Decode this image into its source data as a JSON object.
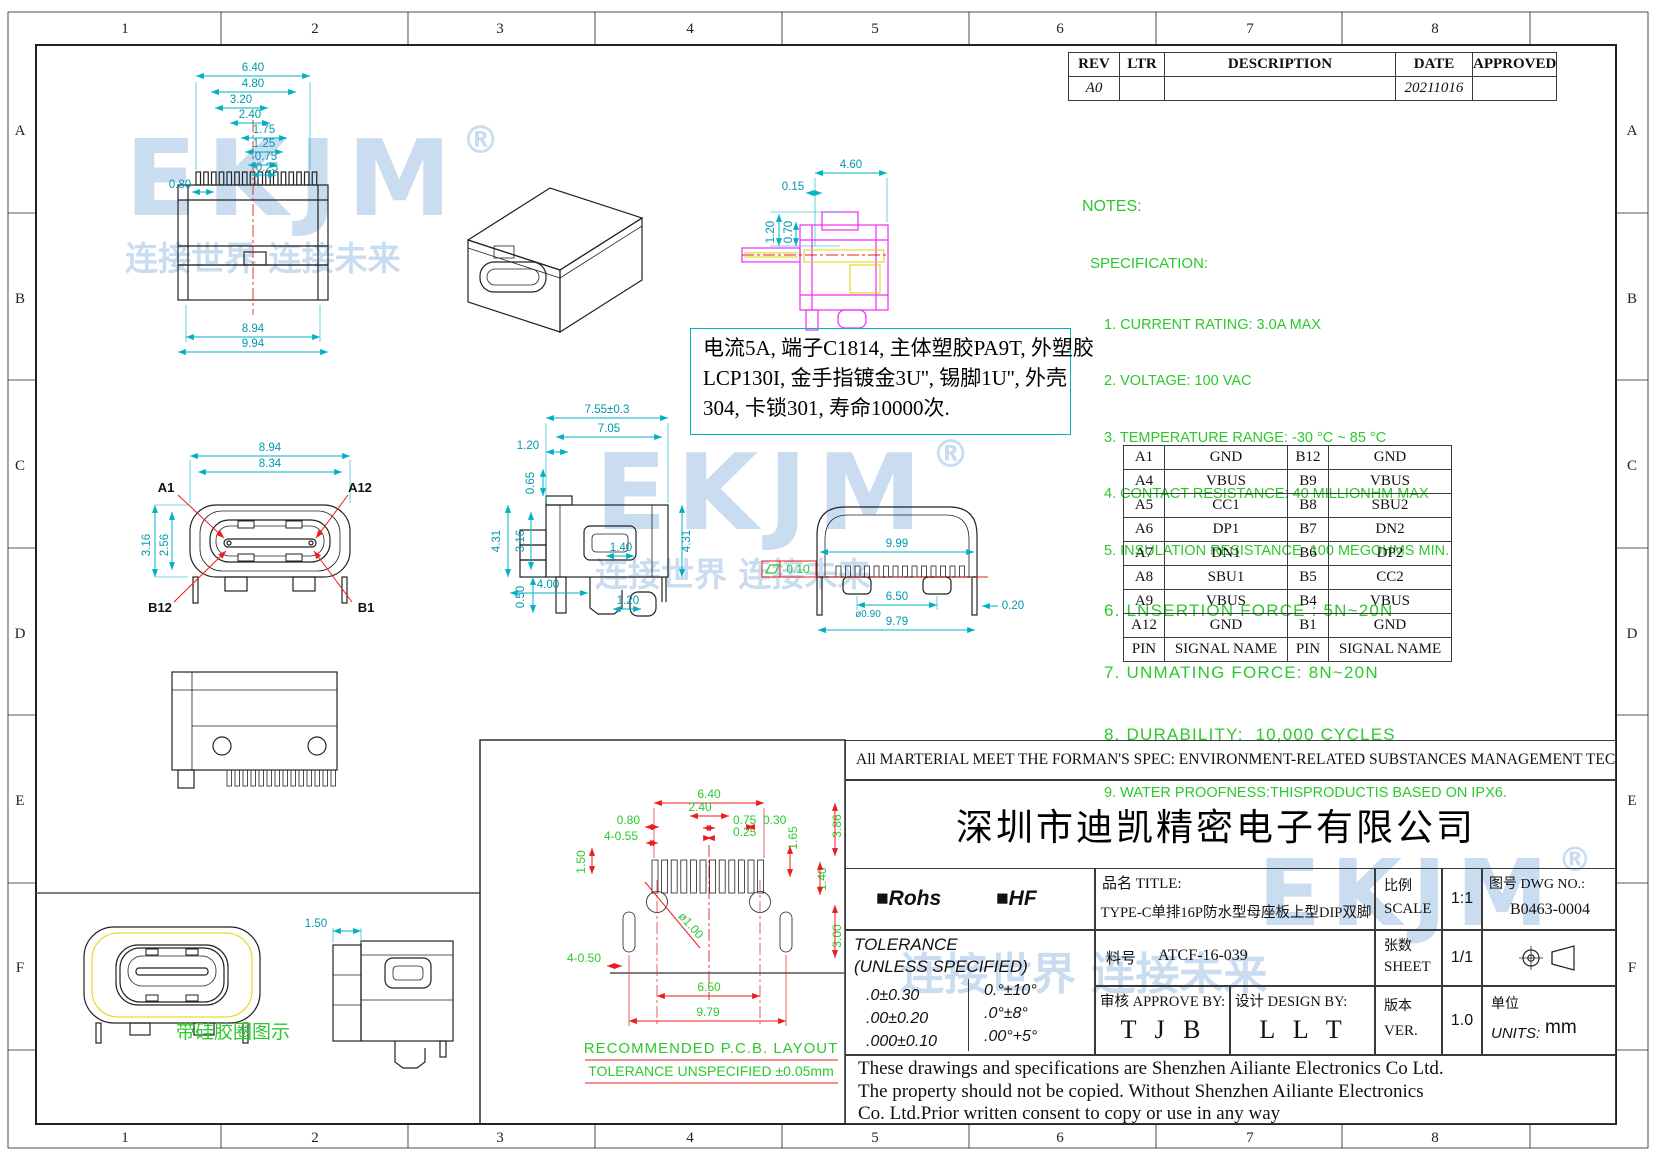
{
  "colors": {
    "cyan": "#00b0c4",
    "green": "#2dc82d",
    "red": "#ec1c1c",
    "magenta": "#f02cf0",
    "yellow": "#e0d200",
    "watermark_blue": "#c9dcf0",
    "line": "#222222"
  },
  "border": {
    "cols": [
      "1",
      "2",
      "3",
      "4",
      "5",
      "6",
      "7",
      "8"
    ],
    "rows": [
      "A",
      "B",
      "C",
      "D",
      "E",
      "F"
    ]
  },
  "rev_table": {
    "headers": [
      "REV",
      "LTR",
      "DESCRIPTION",
      "DATE",
      "APPROVED"
    ],
    "row": {
      "rev": "A0",
      "ltr": "",
      "description": "",
      "date": "20211016",
      "approved": ""
    }
  },
  "watermark": {
    "logo": "EKJM",
    "reg": "®",
    "slogan": "连接世界  连接未来"
  },
  "notes": {
    "title": "NOTES:",
    "subtitle": "SPECIFICATION:",
    "items": [
      "1. CURRENT RATING: 3.0A MAX",
      "2. VOLTAGE: 100 VAC",
      "3. TEMPERATURE RANGE: -30 °C ~ 85 °C",
      "4. CONTACT RESISTANCE: 40 MILLIONHM MAX",
      "5. INSULATION RESISTANCE: 100 MEGOHMS MIN.",
      "6. LNSERTION FORCE : 5N~20N",
      "7. UNMATING FORCE: 8N~20N",
      "8. DURABILITY:  10,000 CYCLES",
      "9. WATER PROOFNESS:THISPRODUCTIS BASED ON IPX6."
    ]
  },
  "material_note": {
    "lines": [
      "电流5A, 端子C1814, 主体塑胶PA9T, 外塑胶",
      "LCP130I, 金手指镀金3U'', 锡脚1U'', 外壳",
      "304, 卡锁301, 寿命10000次."
    ]
  },
  "pin_table": {
    "rows": [
      [
        "A1",
        "GND",
        "B12",
        "GND"
      ],
      [
        "A4",
        "VBUS",
        "B9",
        "VBUS"
      ],
      [
        "A5",
        "CC1",
        "B8",
        "SBU2"
      ],
      [
        "A6",
        "DP1",
        "B7",
        "DN2"
      ],
      [
        "A7",
        "DN1",
        "B6",
        "DP2"
      ],
      [
        "A8",
        "SBU1",
        "B5",
        "CC2"
      ],
      [
        "A9",
        "VBUS",
        "B4",
        "VBUS"
      ],
      [
        "A12",
        "GND",
        "B1",
        "GND"
      ],
      [
        "PIN",
        "SIGNAL NAME",
        "PIN",
        "SIGNAL NAME"
      ]
    ]
  },
  "views": {
    "plan": {
      "dims": [
        "6.40",
        "4.80",
        "3.20",
        "2.40",
        "1.75",
        "1.25",
        "0.75",
        "0.25",
        "0.80",
        "8.94",
        "9.94"
      ]
    },
    "section": {
      "dims": [
        "4.60",
        "0.15",
        "1.20",
        "0.70"
      ]
    },
    "front": {
      "dims": [
        "8.94",
        "8.34",
        "3.16",
        "2.56"
      ],
      "pins": [
        "A1",
        "A12",
        "B12",
        "B1"
      ]
    },
    "side": {
      "dims": [
        "7.55±0.3",
        "7.05",
        "1.20",
        "0.65",
        "4.31",
        "3.16",
        "4.31",
        "1.40",
        "0.50",
        "1.20",
        "4.00"
      ]
    },
    "rear": {
      "dims": [
        "9.99",
        "6.50",
        "ø0.90",
        "9.79",
        "0.20"
      ],
      "flatness": "0.10"
    },
    "gasket": {
      "dim": "1.50",
      "label": "带硅胶圈图示"
    }
  },
  "pcb": {
    "dims": [
      "6.40",
      "2.40",
      "0.75",
      "0.25",
      "0.80",
      "4-0.55",
      "0.30",
      "1.65",
      "1.50",
      "1.40",
      "ø1.00",
      "4-0.50",
      "6.50",
      "9.79",
      "3.00",
      "3.86"
    ],
    "label1": "RECOMMENDED   P.C.B. LAYOUT",
    "label2": "TOLERANCE UNSPECIFIED ±0.05mm"
  },
  "title_block": {
    "material_strip": "All MARTERIAL MEET THE FORMAN'S SPEC: ENVIRONMENT-RELATED SUBSTANCES MANAGEMENT TECHNICAL STANDARD",
    "company": "深圳市迪凯精密电子有限公司",
    "rohs": "■Rohs",
    "hf": "■HF",
    "title_label": "品名 TITLE:",
    "title_value": "TYPE-C单排16P防水型母座板上型DIP双脚",
    "scale_cn": "比例",
    "scale_en": "SCALE",
    "scale_value": "1:1",
    "dwg_label": "图号 DWG NO.:",
    "dwg_value": "B0463-0004",
    "tol_title": "TOLERANCE",
    "tol_sub": "(UNLESS SPECIFIED)",
    "tol_left": [
      ".0±0.30",
      ".00±0.20",
      ".000±0.10"
    ],
    "tol_right": [
      "0.°±10°",
      ".0°±8°",
      ".00°+5°"
    ],
    "part_label": "料号",
    "part_value": "ATCF-16-039",
    "sheet_cn": "张数",
    "sheet_en": "SHEET",
    "sheet_value": "1/1",
    "approve_label": "审核 APPROVE BY:",
    "approve_value": "T J B",
    "design_label": "设计 DESIGN BY:",
    "design_value": "L L T",
    "ver_cn": "版本",
    "ver_en": "VER.",
    "ver_value": "1.0",
    "units_cn": "单位",
    "units_en": "UNITS:",
    "units_value": "mm",
    "disclaimer": [
      "These drawings and specifications are Shenzhen Ailiante Electronics Co Ltd.",
      "The property should not be copied. Without Shenzhen Ailiante Electronics",
      "Co. Ltd.Prior written consent to copy or use in any way"
    ]
  }
}
